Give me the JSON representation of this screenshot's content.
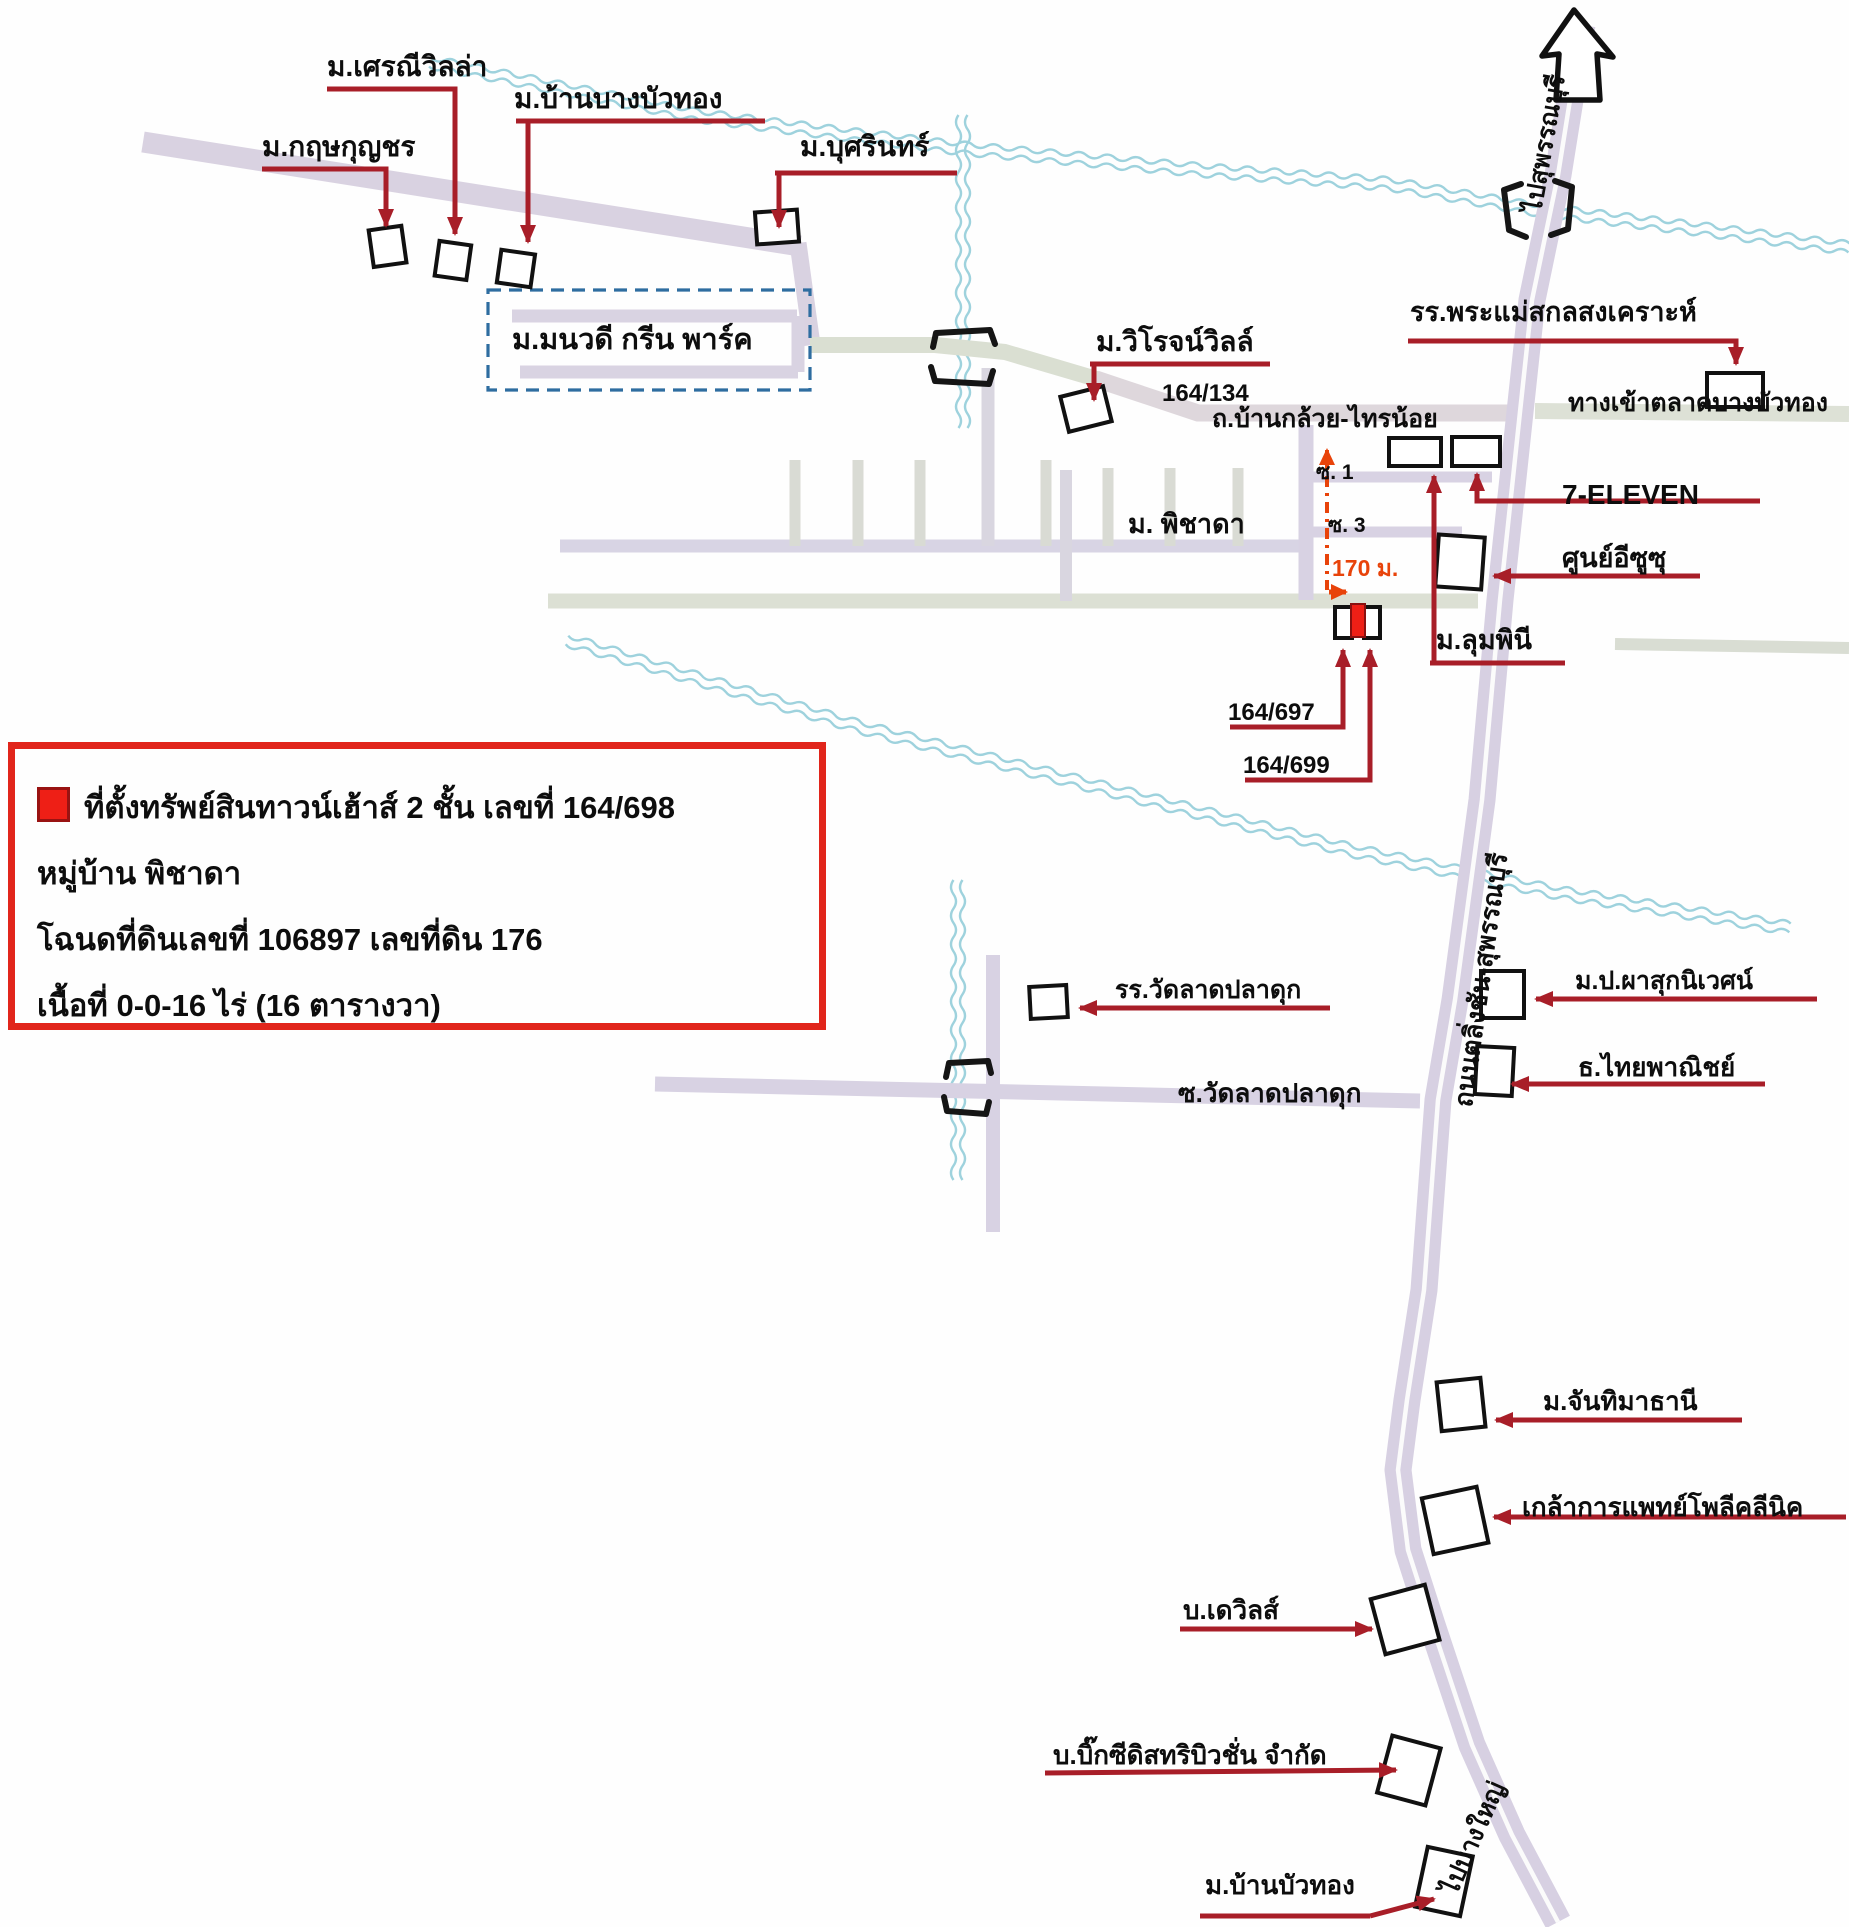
{
  "map": {
    "legend": {
      "marker_color": "#ee1f16",
      "line1": "ที่ตั้งทรัพย์สินทาวน์เฮ้าส์ 2 ชั้น เลขที่ 164/698",
      "line2": "หมู่บ้าน พิชาดา",
      "line3": "โฉนดที่ดินเลขที่ 106897 เลขที่ดิน 176",
      "line4": "เนื้อที่ 0-0-16 ไร่ (16 ตารางวา)"
    },
    "places": {
      "seranee": "ม.เศรณีวิลล่า",
      "krit": "ม.กฤษกุญชร",
      "baanbang": "ม.บ้านบางบัวทอง",
      "busarin": "ม.บุศรินทร์",
      "monwadee": "ม.มนวดี กรีน พาร์ค",
      "wirot": "ม.วิโรจน์วิลล์",
      "pramae": "รร.พระแม่สกลสงเคราะห์",
      "seven": "7-ELEVEN",
      "isuzu": "ศูนย์อีซูซุ",
      "lumpini": "ม.ลุมพินี",
      "pichada": "ม. พิชาดา",
      "watlat_school": "รร.วัดลาดปลาดุก",
      "phasuk": "ม.ป.ผาสุกนิเวศน์",
      "scb": "ธ.ไทยพาณิชย์",
      "chanthima": "ม.จันทิมาธานี",
      "klao": "เกล้าการแพทย์โพลีคลีนิค",
      "devils": "บ.เดวิลส์",
      "bigc": "บ.บิ๊กซีดิสทริบิวชั่น จำกัด",
      "baanbuathong": "ม.บ้านบัวทอง"
    },
    "road_labels": {
      "bankluai": "ถ.บ้านกล้วย-ไทรน้อย",
      "market_entrance": "ทางเข้าตลาดบางบัวทอง",
      "talingchan": "ถนนตลิ่งชัน-สุพรรณบุรี",
      "to_suphanburi": "ไปสุพรรณบุรี",
      "to_bangyai": "ไปบางใหญ่",
      "soi_watlat": "ซ.วัดลาดปลาดุก",
      "soi1": "ซ. 1",
      "soi3": "ซ. 3"
    },
    "annotations": {
      "house_134": "164/134",
      "house_697": "164/697",
      "house_699": "164/699",
      "distance": "170 ม."
    }
  }
}
